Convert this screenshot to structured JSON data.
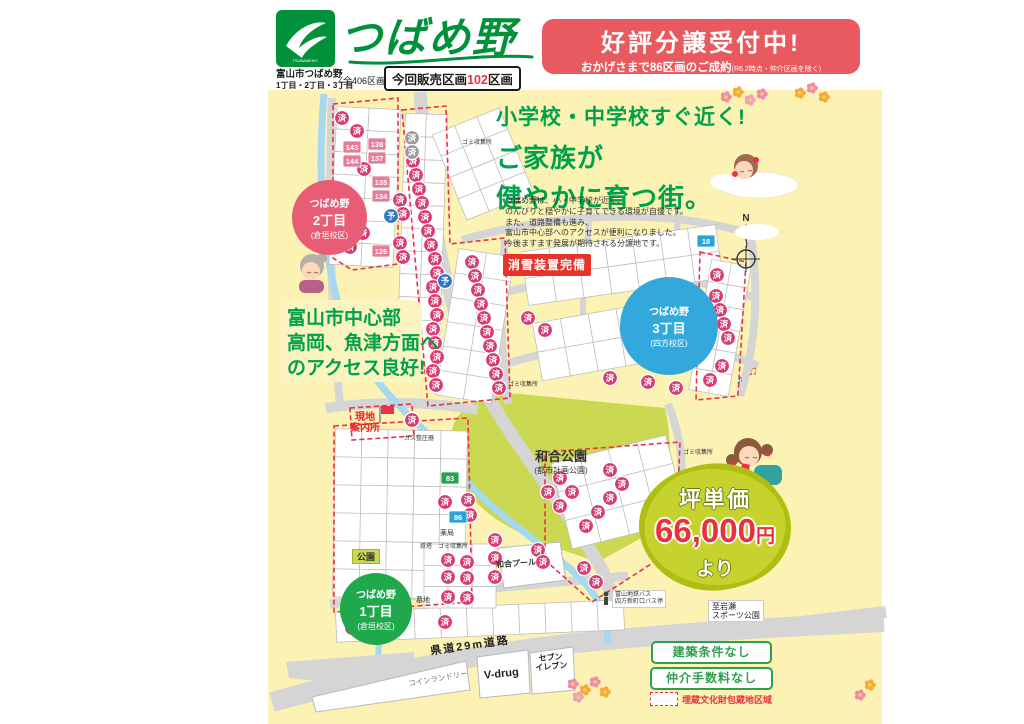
{
  "header": {
    "logo_mark": "TSUBAMENO",
    "brand": "つばめ野",
    "city_line1": "富山市つばめ野",
    "city_line2": "1丁目・2丁目・3丁目",
    "total": "〈全406区画〉",
    "sale_prefix": "今回販売区画",
    "sale_count": "102",
    "sale_suffix": "区画"
  },
  "banner": {
    "title": "好評分譲受付中!",
    "sub": "おかげさまで86区画のご成約",
    "note": "(R6.2時点・仲介区画を除く)"
  },
  "headline": {
    "l1": "小学校・中学校すぐ近く!",
    "l2": "ご家族が",
    "l3": "健やかに育つ街。"
  },
  "description": {
    "lines": [
      "つばめ野は、小・中学校が近く、",
      "のんびりと穏やかに子育てできる環境が自慢です。",
      "また、道路整備も進み、",
      "富山市中心部へのアクセスが便利になりました。",
      "今後ますます発展が期待される分譲地です。"
    ]
  },
  "snow_badge": "消雪装置完備",
  "access": {
    "l1": "富山市中心部",
    "l2": "高岡、魚津方面へ",
    "l3": "のアクセス良好!"
  },
  "price": {
    "label": "坪単価",
    "amount": "66,000",
    "unit": "円",
    "suffix": "より"
  },
  "districts": [
    {
      "line1": "つばめ野",
      "line2": "1丁目",
      "school": "(倉垣校区)",
      "color": "#1fa84c"
    },
    {
      "line1": "つばめ野",
      "line2": "2丁目",
      "school": "(倉垣校区)",
      "color": "#e85d75"
    },
    {
      "line1": "つばめ野",
      "line2": "3丁目",
      "school": "(四方校区)",
      "color": "#33a8dd"
    }
  ],
  "legend": {
    "item1": "建築条件なし",
    "item2": "仲介手数料なし",
    "buried": "埋蔵文化財包蔵地区域"
  },
  "labels": {
    "office1": "現地",
    "office2": "案内所",
    "park_name": "和合公園",
    "park_sub": "(都市計画公園)",
    "pool": "和合プール",
    "small_park": "公園",
    "road": "県道29m道路",
    "to_sports1": "至岩瀬",
    "to_sports2": "スポーツ公園",
    "bus1": "富山地鉄バス",
    "bus2": "四方新町口バス停",
    "laundry": "コインランドリー",
    "vdrug": "V-drug",
    "seven1": "セブン",
    "seven2": "イレブン",
    "garbage": "ゴミ収集所",
    "tower": "鉄塔",
    "pharmacy": "薬局",
    "grave": "墓地",
    "gas": "ガス整圧器",
    "compass": "N"
  },
  "map": {
    "sold_label": "済",
    "reserved_label": "予",
    "sold": [
      [
        342,
        118
      ],
      [
        357,
        131
      ],
      [
        364,
        169
      ],
      [
        350,
        205
      ],
      [
        363,
        233
      ],
      [
        350,
        247
      ],
      [
        413,
        161
      ],
      [
        416,
        175
      ],
      [
        419,
        189
      ],
      [
        422,
        203
      ],
      [
        425,
        217
      ],
      [
        428,
        231
      ],
      [
        431,
        245
      ],
      [
        400,
        200
      ],
      [
        403,
        214
      ],
      [
        400,
        243
      ],
      [
        403,
        257
      ],
      [
        435,
        259
      ],
      [
        437,
        273
      ],
      [
        433,
        287
      ],
      [
        435,
        301
      ],
      [
        437,
        315
      ],
      [
        433,
        329
      ],
      [
        435,
        343
      ],
      [
        437,
        357
      ],
      [
        433,
        371
      ],
      [
        436,
        385
      ],
      [
        472,
        262
      ],
      [
        475,
        276
      ],
      [
        478,
        290
      ],
      [
        481,
        304
      ],
      [
        484,
        318
      ],
      [
        487,
        332
      ],
      [
        490,
        346
      ],
      [
        493,
        360
      ],
      [
        496,
        374
      ],
      [
        499,
        388
      ],
      [
        528,
        318
      ],
      [
        545,
        330
      ],
      [
        610,
        378
      ],
      [
        648,
        382
      ],
      [
        676,
        388
      ],
      [
        717,
        275
      ],
      [
        716,
        296
      ],
      [
        720,
        310
      ],
      [
        724,
        324
      ],
      [
        728,
        338
      ],
      [
        722,
        366
      ],
      [
        710,
        380
      ],
      [
        560,
        478
      ],
      [
        548,
        492
      ],
      [
        560,
        506
      ],
      [
        572,
        492
      ],
      [
        610,
        470
      ],
      [
        622,
        484
      ],
      [
        610,
        498
      ],
      [
        598,
        512
      ],
      [
        586,
        526
      ],
      [
        445,
        502
      ],
      [
        468,
        500
      ],
      [
        470,
        515
      ],
      [
        448,
        560
      ],
      [
        467,
        562
      ],
      [
        448,
        577
      ],
      [
        467,
        578
      ],
      [
        448,
        597
      ],
      [
        467,
        598
      ],
      [
        495,
        540
      ],
      [
        495,
        558
      ],
      [
        495,
        577
      ],
      [
        538,
        550
      ],
      [
        543,
        562
      ],
      [
        584,
        568
      ],
      [
        596,
        582
      ],
      [
        352,
        628
      ],
      [
        363,
        628
      ],
      [
        445,
        622
      ],
      [
        412,
        420
      ]
    ],
    "reserved": [
      [
        391,
        216
      ],
      [
        445,
        281
      ],
      [
        357,
        230
      ]
    ],
    "sold_gray": [
      [
        412,
        138
      ],
      [
        412,
        152
      ]
    ],
    "pink_lots": [
      [
        "143",
        352,
        147
      ],
      [
        "144",
        352,
        161
      ],
      [
        "138",
        377,
        144
      ],
      [
        "137",
        377,
        158
      ],
      [
        "135",
        381,
        182
      ],
      [
        "134",
        381,
        196
      ],
      [
        "128",
        352,
        213
      ],
      [
        "126",
        381,
        251
      ],
      [
        "108",
        380,
        312
      ]
    ],
    "blue_lots": [
      [
        "18",
        706,
        241
      ],
      [
        "86",
        458,
        517
      ]
    ],
    "green_lots": [
      [
        "83",
        450,
        478
      ]
    ]
  }
}
